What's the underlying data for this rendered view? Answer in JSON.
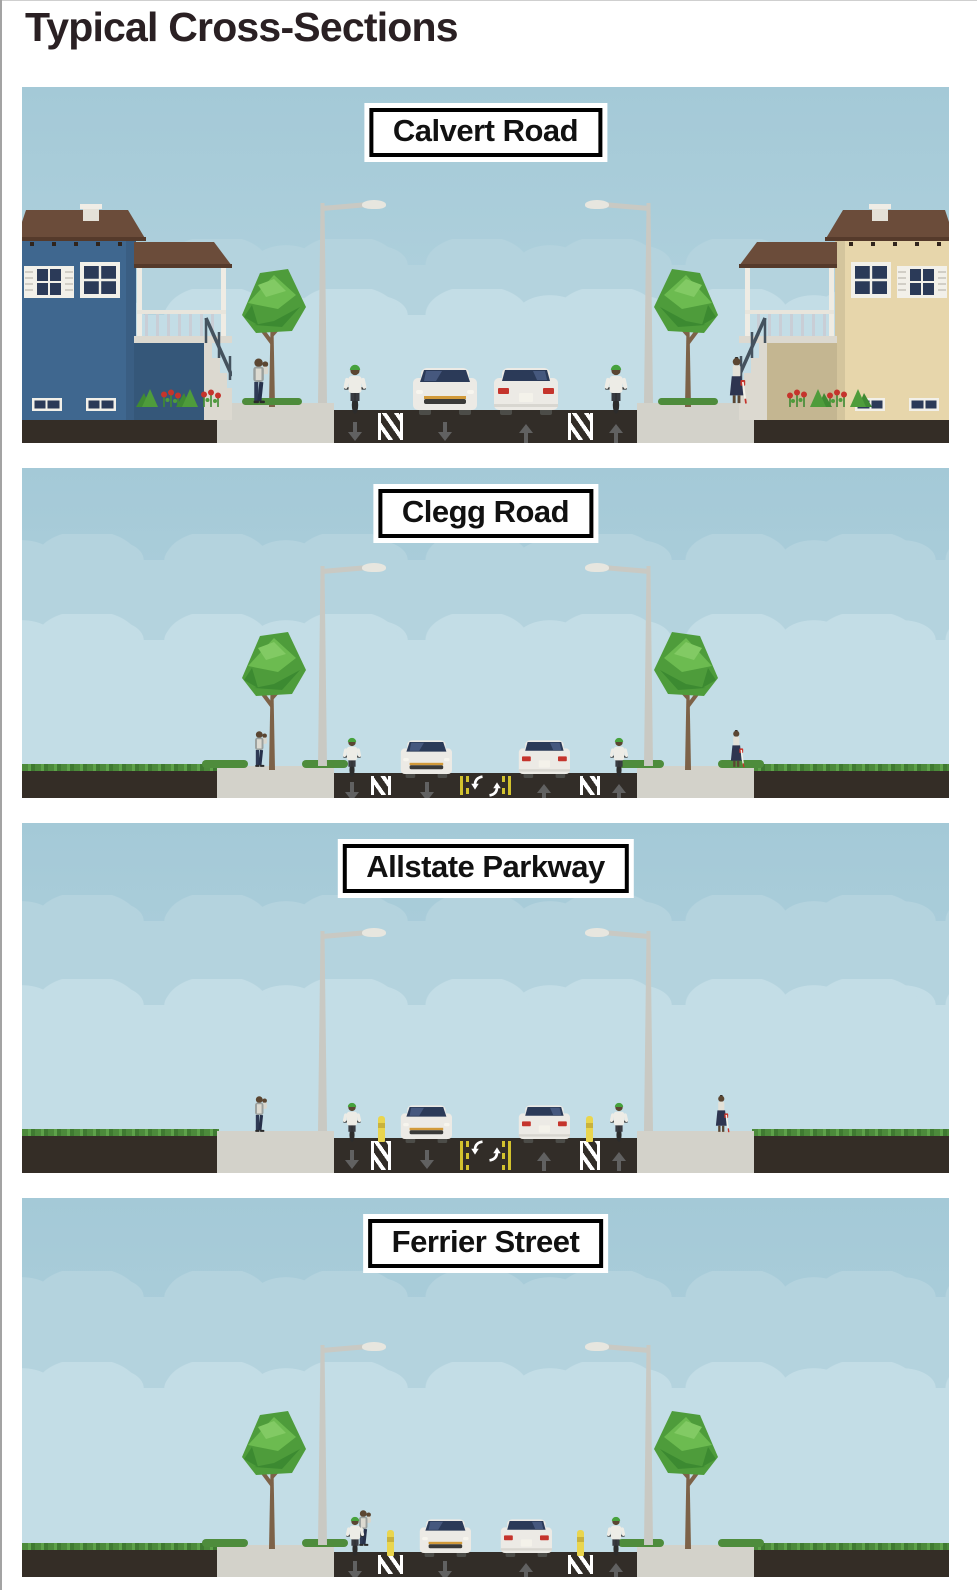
{
  "page": {
    "title": "Typical Cross-Sections"
  },
  "panels": [
    {
      "id": "calvert-road",
      "label": "Calvert Road",
      "scene": {
        "setting": "residential street with houses on both sides",
        "houses": 2,
        "grass_boulevards": false,
        "street_trees": 2,
        "street_lamps": 2,
        "pedestrians": 2,
        "cyclists": 2,
        "cars": 2,
        "flower_beds": true,
        "lanes": [
          "bike-down",
          "painted-buffer",
          "travel-down",
          "travel-up",
          "painted-buffer",
          "bike-up"
        ],
        "road_markings": [
          "lane-direction-arrows",
          "painted-buffer-hatching"
        ]
      }
    },
    {
      "id": "clegg-road",
      "label": "Clegg Road",
      "scene": {
        "setting": "street with grass boulevards and sidewalks",
        "houses": 0,
        "grass_boulevards": true,
        "street_trees": 2,
        "street_lamps": 2,
        "pedestrians": 2,
        "cyclists": 2,
        "cars": 2,
        "flower_beds": false,
        "lanes": [
          "bike-down",
          "painted-buffer",
          "travel-down",
          "center-turn",
          "travel-up",
          "painted-buffer",
          "bike-up"
        ],
        "road_markings": [
          "lane-direction-arrows",
          "painted-buffer-hatching",
          "double-yellow-center-lines",
          "center-turn-lane-arrows"
        ]
      }
    },
    {
      "id": "allstate-parkway",
      "label": "Allstate Parkway",
      "scene": {
        "setting": "street with grass boulevards, no street trees",
        "houses": 0,
        "grass_boulevards": true,
        "street_trees": 0,
        "street_lamps": 2,
        "pedestrians": 2,
        "cyclists": 2,
        "cars": 2,
        "flower_beds": false,
        "lanes": [
          "bike-down",
          "flex-post-buffer",
          "travel-down",
          "center-turn",
          "travel-up",
          "flex-post-buffer",
          "bike-up"
        ],
        "road_markings": [
          "lane-direction-arrows",
          "buffer-hatching",
          "double-yellow-center-lines",
          "center-turn-lane-arrows",
          "flex-post-bollards"
        ]
      }
    },
    {
      "id": "ferrier-street",
      "label": "Ferrier Street",
      "scene": {
        "setting": "street with grass boulevards and street trees",
        "houses": 0,
        "grass_boulevards": true,
        "street_trees": 2,
        "street_lamps": 2,
        "pedestrians": 1,
        "cyclists": 2,
        "cars": 2,
        "flower_beds": false,
        "lanes": [
          "bike-down",
          "flex-post-buffer",
          "travel-down",
          "travel-up",
          "flex-post-buffer",
          "bike-up"
        ],
        "road_markings": [
          "lane-direction-arrows",
          "buffer-hatching",
          "flex-post-bollards"
        ]
      }
    }
  ],
  "colors": {
    "sky_top": "#a4c9d7",
    "sky_bottom": "#bbd8e2",
    "cloud_band_1": "#b4d3de",
    "cloud_band_2": "#c3dde6",
    "road": "#322d28",
    "soil": "#342d26",
    "sidewalk": "#d3d2ca",
    "grass": "#4c8a3b",
    "lane_arrow": "#616161",
    "buffer_white": "#ffffff",
    "center_line_yellow": "#d2c22e",
    "flex_post_yellow": "#e9d54e",
    "tree_green": "#4e9c3b",
    "trunk_brown": "#7d6248",
    "house_blue": "#3f678f",
    "house_tan": "#e7d6ab",
    "roof_brown": "#6b4c3a",
    "helmet_green": "#47a23d",
    "taillight_red": "#c5342c",
    "car_body": "#eceae5",
    "windshield": "#2b3a58",
    "label_bg": "#ffffff",
    "label_border": "#000000",
    "title_text": "#2a2023"
  }
}
